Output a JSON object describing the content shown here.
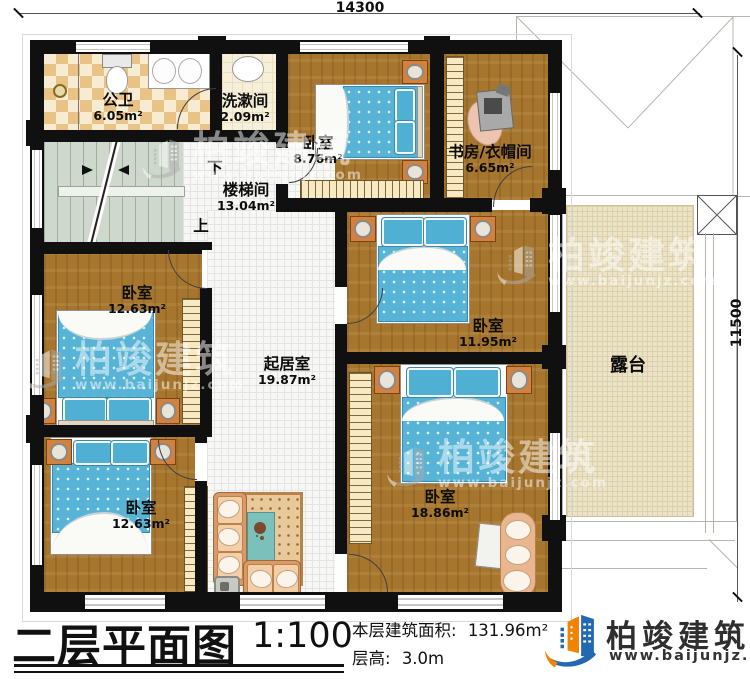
{
  "dims": {
    "top": "14300",
    "right": "11500"
  },
  "rooms": [
    {
      "name": "公卫",
      "area": "6.05m²"
    },
    {
      "name": "洗漱间",
      "area": "2.09m²"
    },
    {
      "name": "卧室",
      "area": "8.76m²"
    },
    {
      "name": "书房/衣帽间",
      "area": "6.65m²"
    },
    {
      "name": "楼梯间",
      "area": "13.04m²"
    },
    {
      "name": "卧室",
      "area": "12.63m²"
    },
    {
      "name": "起居室",
      "area": "19.87m²"
    },
    {
      "name": "卧室",
      "area": "11.95m²"
    },
    {
      "name": "卧室",
      "area": "18.86m²"
    },
    {
      "name": "卧室",
      "area": "12.63m²"
    },
    {
      "name": "露台",
      "area": ""
    }
  ],
  "stair": {
    "down": "下",
    "up": "上"
  },
  "footer": {
    "title": "二层平面图",
    "scale": "1:100",
    "area_label": "本层建筑面积:",
    "area_value": "131.96m²",
    "height_label": "层高:",
    "height_value": "3.0m"
  },
  "brand": {
    "name": "柏竣建筑",
    "url": "www.baijunjz.com"
  },
  "watermark": {
    "text": "柏竣建筑",
    "url": "www.baijunjz.com"
  },
  "colors": {
    "wall": "#101010",
    "wood": "#a6762e",
    "bed_blue": "#58b4d6",
    "logo_blue": "#2369b0",
    "logo_orange": "#f08300",
    "terrace": "#ece3c6"
  }
}
